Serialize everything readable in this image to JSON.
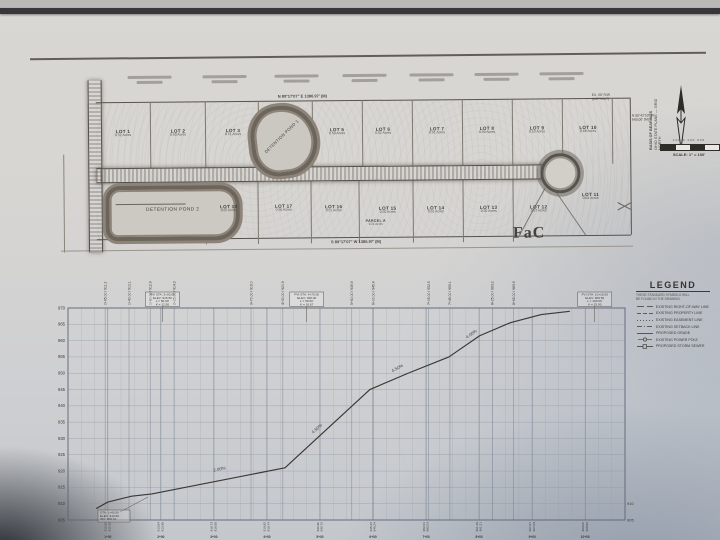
{
  "plan": {
    "bearing_top": "N 89°17'07\" E   1386.97' (M)",
    "bearing_bottom": "S 89°17'07\" W   1385.97' (M)",
    "soil_label": "FaC",
    "pond1_label": "DETENTION POND 1",
    "pond2_label": "DETENTION POND 2",
    "parcel_label": "PARCEL A",
    "parcel_area": "0.21 Acres",
    "top_lots": [
      {
        "name": "LOT 1",
        "area": "0.52 Acres"
      },
      {
        "name": "LOT 2",
        "area": "0.50 Acres"
      },
      {
        "name": "LOT 3",
        "area": "0.51 Acres"
      },
      {
        "name": "LOT 5",
        "area": "0.50 Acres"
      },
      {
        "name": "LOT 6",
        "area": "0.52 Acres"
      },
      {
        "name": "LOT 7",
        "area": "0.51 Acres"
      },
      {
        "name": "LOT 8",
        "area": "0.50 Acres"
      },
      {
        "name": "LOT 9",
        "area": "0.53 Acres"
      },
      {
        "name": "LOT 10",
        "area": "0.68 Acres"
      }
    ],
    "bottom_lots": [
      {
        "name": "LOT 18",
        "area": "0.55 Acres"
      },
      {
        "name": "LOT 17",
        "area": "0.50 Acres"
      },
      {
        "name": "LOT 16",
        "area": "0.51 Acres"
      },
      {
        "name": "LOT 15",
        "area": "0.50 Acres"
      },
      {
        "name": "LOT 14",
        "area": "0.52 Acres"
      },
      {
        "name": "LOT 13",
        "area": "0.50 Acres"
      },
      {
        "name": "LOT 12",
        "area": "0.57 Acres"
      },
      {
        "name": "LOT 11",
        "area": "0.64 Acres"
      }
    ],
    "rw_note": [
      "EX. 60' R/W",
      "(ASPHALT)"
    ],
    "east_note": [
      "N 00°42'53\" W",
      "660.00' (M)"
    ],
    "north_line1": "BASIS OF BEARINGS",
    "north_line2": "OHIO STATE PLANE — GRID NORTH",
    "scale_ticks": "100   0   100   200",
    "scale_label": "SCALE: 1\" = 100'"
  },
  "legend": {
    "title": "LEGEND",
    "subtitle1": "THESE STANDARD SYMBOLS WILL",
    "subtitle2": "BE FOUND IN THE DRAWING.",
    "items": [
      {
        "pattern": "longdash",
        "label": "EXISTING RIGHT-OF-WAY LINE"
      },
      {
        "pattern": "dash",
        "label": "EXISTING PROPERTY LINE"
      },
      {
        "pattern": "dot",
        "label": "EXISTING EASEMENT LINE"
      },
      {
        "pattern": "dashdot",
        "label": "EXISTING SETBACK LINE"
      },
      {
        "pattern": "solid",
        "label": "PROPOSED GRADE"
      },
      {
        "pattern": "pole",
        "label": "EXISTING POWER POLE"
      },
      {
        "pattern": "storm",
        "label": "PROPOSED STORM SEWER"
      }
    ]
  },
  "chart_data": {
    "type": "line",
    "title": "ROAD CENTERLINE PROFILE",
    "xlabel": "STATION",
    "ylabel": "ELEVATION (FT)",
    "elev_min": 905,
    "elev_max": 970,
    "elev_step": 5,
    "sta_min": 25,
    "sta_max": 1075,
    "minor_step": 25,
    "major_step": 100,
    "profile": [
      [
        78,
        908.5
      ],
      [
        100,
        910.5
      ],
      [
        145,
        912.3
      ],
      [
        183,
        913.0
      ],
      [
        434,
        921.0
      ],
      [
        594,
        945.0
      ],
      [
        666,
        950.0
      ],
      [
        743,
        955.0
      ],
      [
        801,
        961.5
      ],
      [
        859,
        965.5
      ],
      [
        917,
        968.0
      ],
      [
        971,
        969.0
      ]
    ],
    "slope_labels": [
      {
        "sta": 311,
        "elev": 919.5,
        "text": "2.00%",
        "rot": -12
      },
      {
        "sta": 496,
        "elev": 932.0,
        "text": "4.50%",
        "rot": -42
      },
      {
        "sta": 647,
        "elev": 950.5,
        "text": "4.50%",
        "rot": -28
      },
      {
        "sta": 787,
        "elev": 961.0,
        "text": "4.00%",
        "rot": -35
      }
    ],
    "pvi_boxes": [
      {
        "sta": 203,
        "lines": [
          "PVI STA: 2+03.00",
          "ELEV: 916.50",
          "L = 50.00'",
          "K = 12.50"
        ]
      },
      {
        "sta": 475,
        "lines": [
          "PVI STA: 4+75.00",
          "ELEV: 928.00",
          "L = 50.00'",
          "K = 16.67"
        ]
      },
      {
        "sta": 1018,
        "lines": [
          "PVI STA: 10+18.00",
          "ELEV: 969.50",
          "L = 100.00'",
          "K = 25.00"
        ]
      }
    ],
    "vc_callouts": [
      {
        "sta": 95,
        "text": "0+95.00 / 911.2"
      },
      {
        "sta": 140,
        "text": "1+40.00 / 912.1"
      },
      {
        "sta": 180,
        "text": "1+80.00 / 912.9"
      },
      {
        "sta": 225,
        "text": "2+25.00 / 914.3"
      },
      {
        "sta": 370,
        "text": "3+70.00 / 919.0"
      },
      {
        "sta": 430,
        "text": "4+30.00 / 920.9"
      },
      {
        "sta": 560,
        "text": "5+60.00 / 939.9"
      },
      {
        "sta": 600,
        "text": "6+00.00 / 945.4"
      },
      {
        "sta": 705,
        "text": "7+05.00 / 952.5"
      },
      {
        "sta": 745,
        "text": "7+45.00 / 955.1"
      },
      {
        "sta": 825,
        "text": "8+25.00 / 963.2"
      },
      {
        "sta": 865,
        "text": "8+65.00 / 965.9"
      }
    ],
    "bottom_stations": [
      {
        "sta": 100,
        "label": "1+00"
      },
      {
        "sta": 200,
        "label": "2+00"
      },
      {
        "sta": 300,
        "label": "3+00"
      },
      {
        "sta": 400,
        "label": "4+00"
      },
      {
        "sta": 500,
        "label": "5+00"
      },
      {
        "sta": 600,
        "label": "6+00"
      },
      {
        "sta": 700,
        "label": "7+00"
      },
      {
        "sta": 800,
        "label": "8+00"
      },
      {
        "sta": 900,
        "label": "9+00"
      },
      {
        "sta": 1000,
        "label": "10+00"
      }
    ],
    "start_note": [
      "STA: 1+43.00",
      "ELEV: 912.60",
      "INV: 909.10"
    ],
    "right_axis_labels": [
      "910",
      "905"
    ]
  }
}
